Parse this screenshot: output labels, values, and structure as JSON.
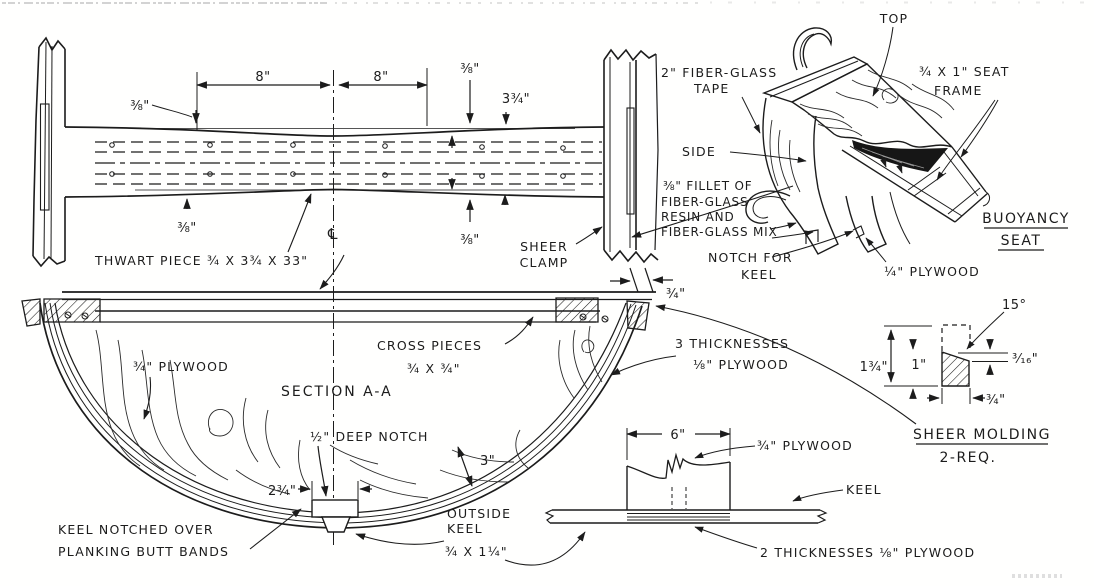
{
  "colors": {
    "ink": "#1c1c1c",
    "paper": "#fffffe"
  },
  "plan_view": {
    "dim_8_left": "8\"",
    "dim_8_right": "8\"",
    "dim_38_top_left": "⅜\"",
    "dim_38_top_right": "⅜\"",
    "dim_3_34": "3¾\"",
    "dim_38_bottom_left": "⅜\"",
    "dim_38_bottom_right": "⅜\"",
    "centerline_symbol": "℄",
    "thwart_label": "THWART PIECE ¾ X 3¾ X 33\"",
    "sheer_clamp_line1": "SHEER",
    "sheer_clamp_line2": "CLAMP",
    "dim_34_gap": "¾\""
  },
  "section_view": {
    "title": "SECTION A-A",
    "plywood_label": "¾\" PLYWOOD",
    "cross_pieces_line1": "CROSS PIECES",
    "cross_pieces_line2": "¾ X ¾\"",
    "thicknesses_line1": "3 THICKNESSES",
    "thicknesses_line2": "⅛\" PLYWOOD",
    "deep_notch_label": "½\" DEEP NOTCH",
    "dim_2_34": "2¾\"",
    "dim_3": "3\"",
    "keel_notched_line1": "KEEL NOTCHED OVER",
    "keel_notched_line2": "PLANKING BUTT BANDS",
    "outside_keel_line1": "OUTSIDE",
    "outside_keel_line2": "KEEL",
    "outside_keel_line3": "¾ X 1¼\""
  },
  "buoyancy_seat": {
    "top_label": "TOP",
    "tape_line1": "2\" FIBER-GLASS",
    "tape_line2": "TAPE",
    "frame_line1": "¾ X 1\" SEAT",
    "frame_line2": "FRAME",
    "side_label": "SIDE",
    "fillet_line1": "⅜\" FILLET OF",
    "fillet_line2": "FIBER-GLASS",
    "fillet_line3": "RESIN AND",
    "fillet_line4": "FIBER-GLASS MIX",
    "notch_line1": "NOTCH  FOR",
    "notch_line2": "KEEL",
    "plywood_label": "¼\" PLYWOOD",
    "caption_line1": "BUOYANCY",
    "caption_line2": "SEAT"
  },
  "sheer_molding": {
    "angle": "15°",
    "dim_1_34": "1¾\"",
    "dim_1": "1\"",
    "dim_3_16": "³⁄₁₆\"",
    "dim_34": "¾\"",
    "caption_line1": "SHEER MOLDING",
    "caption_line2": "2-REQ."
  },
  "keel_detail": {
    "dim_6": "6\"",
    "plywood_label": "¾\" PLYWOOD",
    "keel_label": "KEEL",
    "thicknesses_label": "2 THICKNESSES ⅛\" PLYWOOD"
  }
}
